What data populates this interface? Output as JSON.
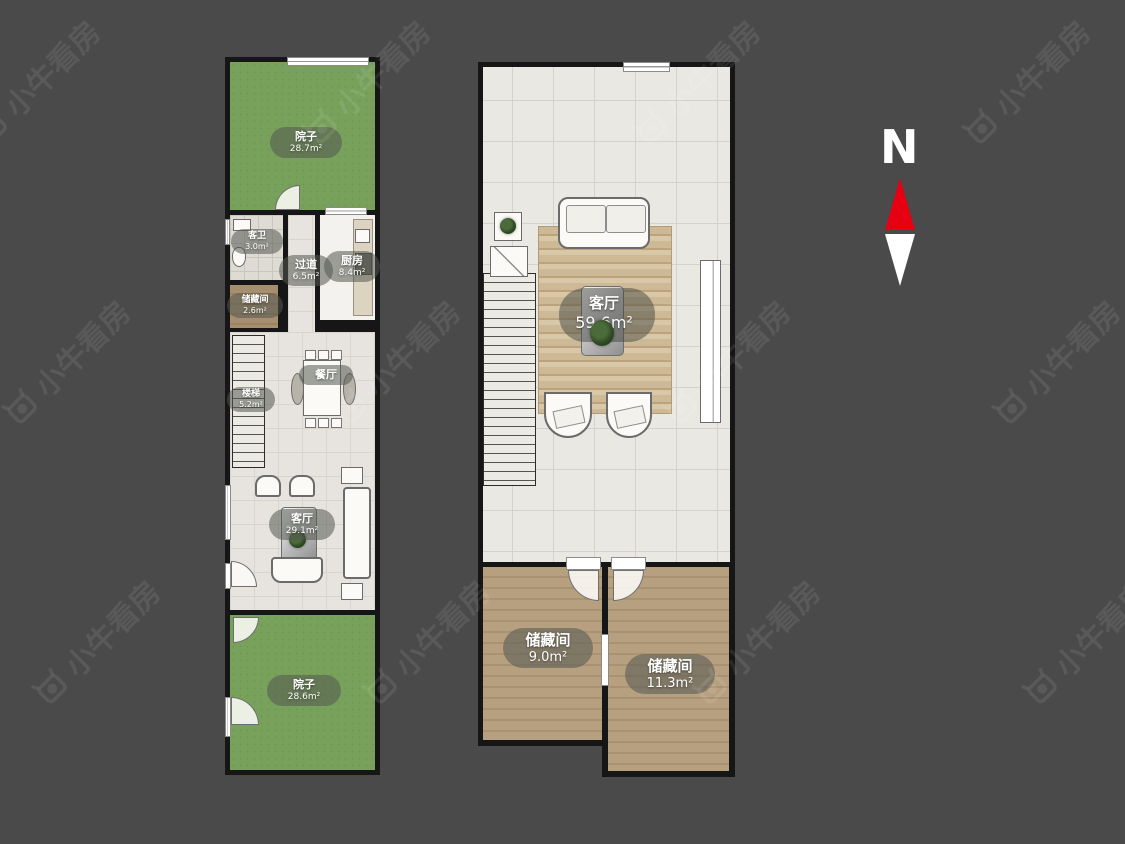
{
  "watermark": {
    "text": "小牛看房"
  },
  "compass": {
    "label": "N",
    "red": "#e60012",
    "white": "#ffffff"
  },
  "colors": {
    "background": "#4a4a4b",
    "wall": "#161616",
    "yard_green": "#78a15c",
    "tile": "#eae8e3",
    "wood": "#b49c7e",
    "rug": "#c8b291"
  },
  "floor1": {
    "rooms": {
      "yard_top": {
        "name": "院子",
        "area": "28.7m²"
      },
      "bath": {
        "name": "客卫",
        "area": "3.0m²"
      },
      "storage": {
        "name": "储藏间",
        "area": "2.6m²"
      },
      "hallway": {
        "name": "过道",
        "area": "6.5m²"
      },
      "kitchen": {
        "name": "厨房",
        "area": "8.4m²"
      },
      "stairs": {
        "name": "楼梯",
        "area": "5.2m²"
      },
      "dining": {
        "name": "餐厅",
        "area": ""
      },
      "living": {
        "name": "客厅",
        "area": "29.1m²"
      },
      "yard_bottom": {
        "name": "院子",
        "area": "28.6m²"
      }
    }
  },
  "floor2": {
    "rooms": {
      "living": {
        "name": "客厅",
        "area": "59.6m²"
      },
      "storage_left": {
        "name": "储藏间",
        "area": "9.0m²"
      },
      "storage_right": {
        "name": "储藏间",
        "area": "11.3m²"
      }
    }
  }
}
